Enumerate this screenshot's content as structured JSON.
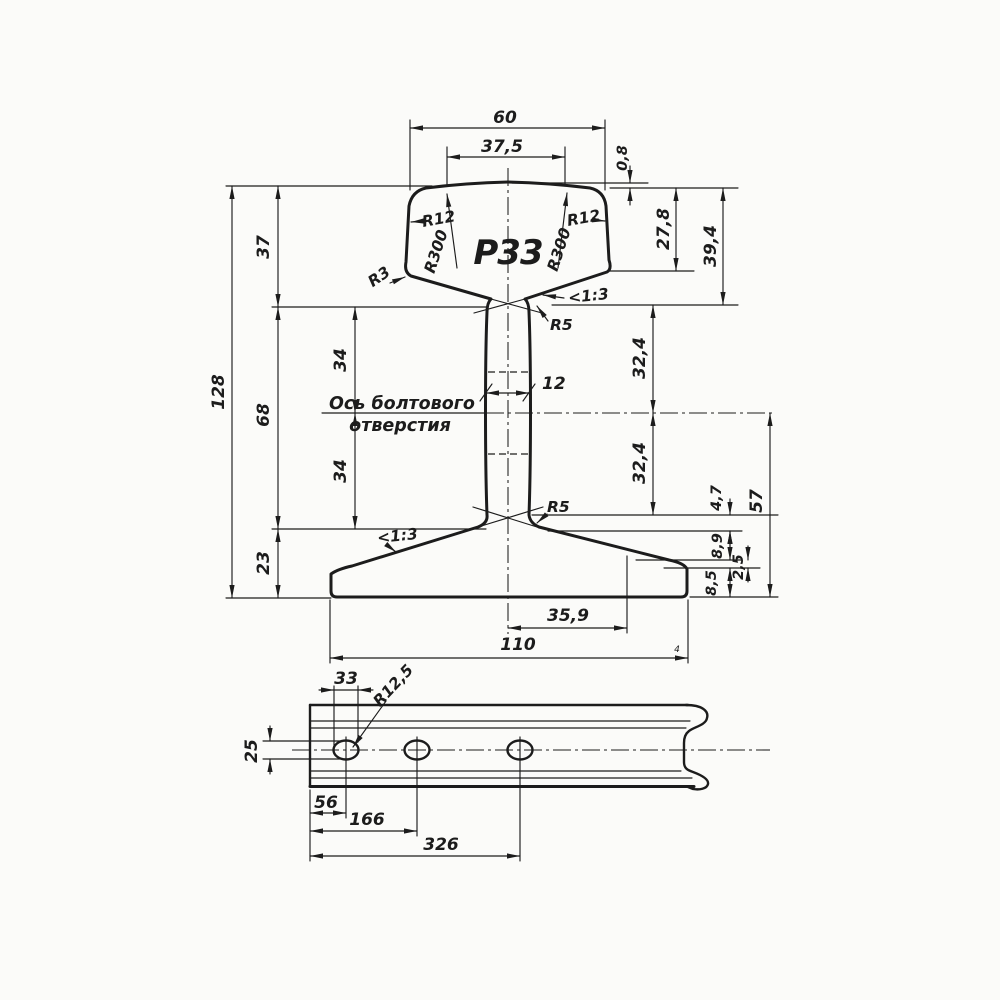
{
  "colors": {
    "ink": "#1c1c1c",
    "paper": "#fbfbf9"
  },
  "cross_section": {
    "profile_label": "Р33",
    "note_line1": "Ось болтового",
    "note_line2": "отверстия",
    "dim_head_width": "60",
    "dim_crown_width": "37,5",
    "dim_crown_drop": "0,8",
    "dim_head_side": "27,8",
    "dim_head_total": "39,4",
    "dim_top_zone": "37",
    "dim_total_height": "128",
    "dim_web_upper": "34",
    "dim_web_lower": "34",
    "dim_web_zone": "68",
    "dim_foot_zone": "23",
    "dim_axis_up": "32,4",
    "dim_axis_down": "32,4",
    "dim_47": "4,7",
    "dim_89": "8,9",
    "dim_25": "2,5",
    "dim_85": "8,5",
    "dim_57": "57",
    "dim_web_thick": "12",
    "dim_foot_half": "35,9",
    "dim_foot_width": "110",
    "mark_small": "4",
    "r12_left": "R12",
    "r12_right": "R12",
    "r300_left": "R300",
    "r300_right": "R300",
    "r3": "R3",
    "r5_upper": "R5",
    "r5_lower": "R5",
    "slope_head": "<1:3",
    "slope_foot": "<1:3"
  },
  "side_view": {
    "dim_hole_length": "33",
    "hole_radius": "R12,5",
    "dim_hole_height": "25",
    "dim_hole1": "56",
    "dim_hole2": "166",
    "dim_hole3": "326"
  }
}
